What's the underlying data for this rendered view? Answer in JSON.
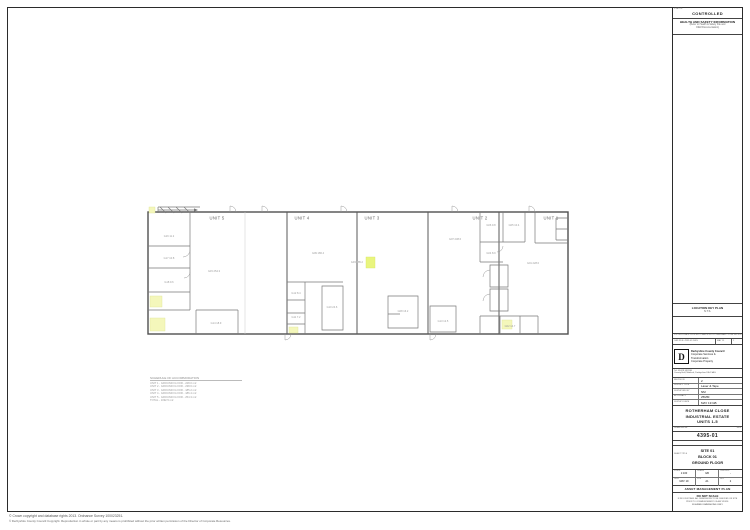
{
  "status_box": {
    "corner_label": "STATUS",
    "status": "CONTROLLED",
    "hs_title": "HEALTH AND SAFETY INFORMATION",
    "hs_subtitle_1": "(Refer to Health & Safety File and",
    "hs_subtitle_2": "O&M Documentation)"
  },
  "location_key": {
    "title": "LOCATION KEY PLAN",
    "scale": "N.T.S."
  },
  "revision_strip": {
    "file_line": "S:\\CORPORATE PROPERTY\\AMP\\4395 ROTHERHAM CLOSE IND EST\\4395-01.DWG",
    "row_desc": "CAD FILE: 4395-01.DWG",
    "row_date": "MAY 19",
    "row_rev": "2"
  },
  "org": {
    "logo_letter": "D",
    "name": "Derbyshire County Council",
    "dept_1": "Corporate Services &",
    "dept_2": "Transformation",
    "dept_3": "Corporate Property",
    "tel": "Tel: 01629 533190",
    "address": "County Hall, Matlock, Derbyshire DE4 3AG"
  },
  "survey_fields": [
    {
      "label": "REVISION",
      "value": "2"
    },
    {
      "label": "SURVEY TYPE",
      "value": "Laser & Tape"
    },
    {
      "label": "SURVEYED BY",
      "value": "NM"
    },
    {
      "label": "ACCURACY",
      "value": "25MM"
    },
    {
      "label": "SURVEY DATE",
      "value": "MAY 19 GB"
    }
  ],
  "title_block": {
    "project_line_1": "ROTHERHAM CLOSE",
    "project_line_2": "INDUSTRIAL ESTATE",
    "project_line_3": "UNITS 1-5",
    "drawing_no_label": "DRAWING No.",
    "rev_label": "REV",
    "drawing_no": "4395-01",
    "sheet_label": "SHEET TITLE",
    "sheet_line_1": "SITE 01",
    "sheet_line_2": "BLOCK 01",
    "sheet_line_3": "GROUND FLOOR",
    "meta": [
      {
        "label": "SCALE",
        "value": "1:100"
      },
      {
        "label": "DRAWN",
        "value": "GB"
      },
      {
        "label": "CHECKED",
        "value": "-"
      },
      {
        "label": "DATE",
        "value": "MAY 19"
      },
      {
        "label": "SIZE",
        "value": "A1"
      },
      {
        "label": "REV",
        "value": "2"
      }
    ],
    "plan_type": "ASSET MANAGEMENT PLAN",
    "notes_title": "DO NOT SCALE",
    "notes_body": "IF IN DOUBT ASK. ALL DIMENSIONS TO BE CHECKED ON SITE PRIOR TO COMMENCEMENT OF ANY WORK.",
    "notes_footer": "FIGURED DIMENSIONS ONLY"
  },
  "plan": {
    "units": [
      "UNIT 5",
      "UNIT 4",
      "UNIT 3",
      "UNIT 2",
      "UNIT 1"
    ],
    "highlight_label": "G03  185.2",
    "room_labels": [
      "G16  11.2",
      "G17  10.8",
      "G18  9.6",
      "G15  254.3",
      "G14  18.9",
      "G12  8.4",
      "G11  7.2",
      "G10  24.6",
      "G09  186.4",
      "G08  16.2",
      "G13  12.5",
      "G07  238.6",
      "G06  9.8",
      "G05  10.4",
      "G04  8.9",
      "G02  14.7",
      "G01  228.0"
    ]
  },
  "schedule": {
    "title": "SCHEDULE OF ACCOMMODATION",
    "rows": [
      "UNIT 1  -  GROUND FLOOR  -  228.0 m2",
      "UNIT 2  -  GROUND FLOOR  -  238.6 m2",
      "UNIT 3  -  GROUND FLOOR  -  185.2 m2",
      "UNIT 4  -  GROUND FLOOR  -  186.4 m2",
      "UNIT 5  -  GROUND FLOOR  -  254.3 m2",
      "TOTAL  -  1092.5 m2"
    ]
  },
  "footer": {
    "line1": "© Crown copyright and database rights 2013. Ordnance Survey 100023251.",
    "line2": "© Derbyshire County Council Copyright. Reproduction in whole or part by any means is prohibited without the prior written permission of the Director of Corporate Resources."
  }
}
